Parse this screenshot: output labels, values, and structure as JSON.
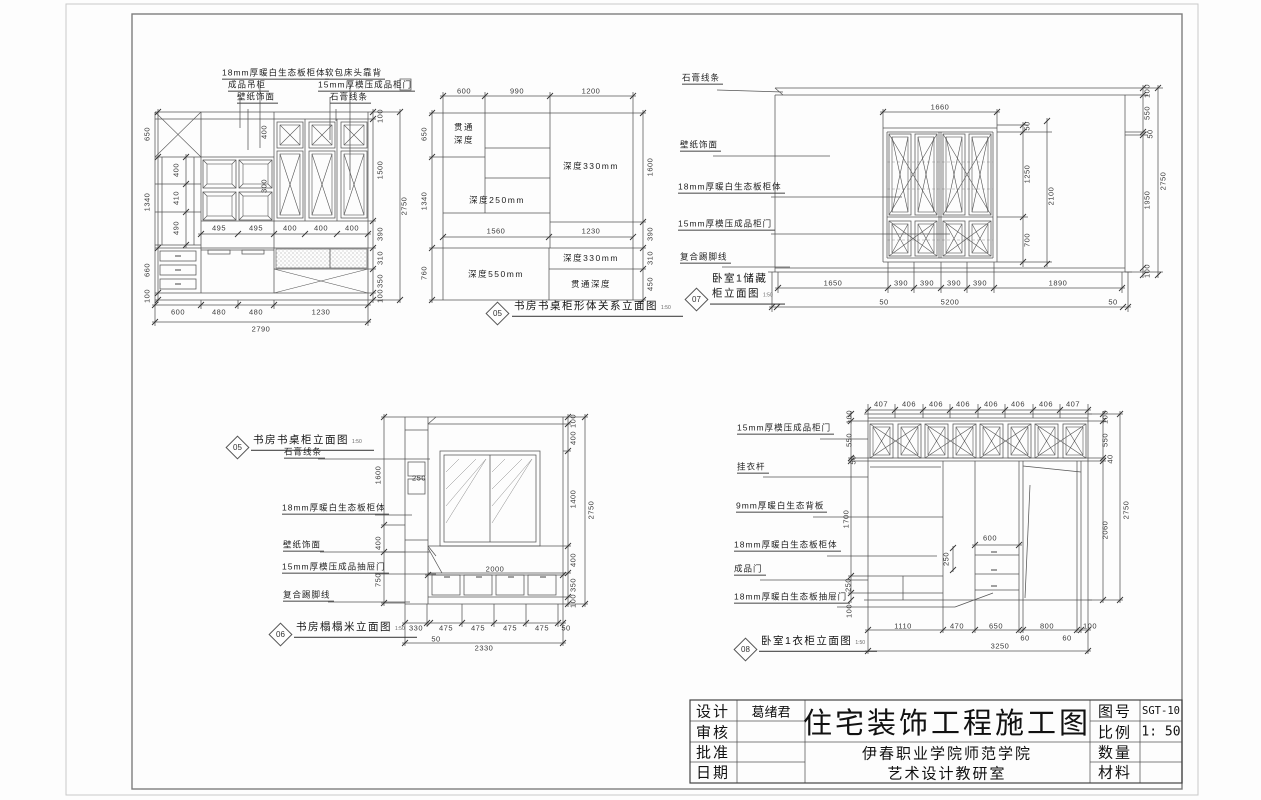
{
  "title_block": {
    "left_rows": [
      {
        "label": "设计",
        "value": "葛绪君"
      },
      {
        "label": "审核",
        "value": ""
      },
      {
        "label": "批准",
        "value": ""
      },
      {
        "label": "日期",
        "value": ""
      }
    ],
    "main_title": "住宅装饰工程施工图",
    "org_lines": [
      "伊春职业学院师范学院",
      "艺术设计教研室"
    ],
    "right_rows": [
      {
        "label": "图号",
        "value": "SGT-10"
      },
      {
        "label": "比例",
        "value": "1: 50"
      },
      {
        "label": "数量",
        "value": ""
      },
      {
        "label": "材料",
        "value": ""
      }
    ]
  },
  "callouts": [
    {
      "num": "05",
      "dx": 497,
      "dy": 313,
      "tx": 512,
      "ty": 317,
      "lines": [
        "书房书桌柜形体关系立面图"
      ],
      "scale": "1:50"
    },
    {
      "num": "07",
      "dx": 696,
      "dy": 299,
      "tx": 710,
      "ty": 305,
      "lines": [
        "卧室1储藏",
        "柜立面图"
      ],
      "scale": "1:50"
    },
    {
      "num": "05",
      "dx": 237,
      "dy": 447,
      "tx": 251,
      "ty": 451,
      "lines": [
        "书房书桌柜立面图"
      ],
      "scale": "1:50"
    },
    {
      "num": "06",
      "dx": 280,
      "dy": 634,
      "tx": 294,
      "ty": 638,
      "lines": [
        "书房榻榻米立面图"
      ],
      "scale": "1:50"
    },
    {
      "num": "08",
      "dx": 745,
      "dy": 649,
      "tx": 759,
      "ty": 652,
      "lines": [
        "卧室1衣柜立面图"
      ],
      "scale": "1:50"
    }
  ],
  "annotations": [
    {
      "k": "l",
      "t": "18mm厚暖白生态板柜体",
      "x": 222,
      "y": 80,
      "u": 1
    },
    {
      "k": "l",
      "t": "软包床头靠背",
      "x": 325,
      "y": 80,
      "u": 1
    },
    {
      "k": "l",
      "t": "成品吊柜",
      "x": 228,
      "y": 92,
      "u": 1
    },
    {
      "k": "l",
      "t": "15mm厚模压成品柜门",
      "x": 318,
      "y": 92,
      "u": 1
    },
    {
      "k": "l",
      "t": "壁纸饰面",
      "x": 237,
      "y": 104,
      "u": 1
    },
    {
      "k": "l",
      "t": "石膏线条",
      "x": 330,
      "y": 104,
      "u": 1
    },
    {
      "k": "d",
      "t": "650",
      "x": 147,
      "y": 134,
      "r": 1
    },
    {
      "k": "d",
      "t": "1340",
      "x": 147,
      "y": 202,
      "r": 1
    },
    {
      "k": "d",
      "t": "660",
      "x": 147,
      "y": 270,
      "r": 1
    },
    {
      "k": "d",
      "t": "100",
      "x": 147,
      "y": 296,
      "r": 1
    },
    {
      "k": "d",
      "t": "400",
      "x": 176,
      "y": 170,
      "r": 1
    },
    {
      "k": "d",
      "t": "410",
      "x": 176,
      "y": 198,
      "r": 1
    },
    {
      "k": "d",
      "t": "490",
      "x": 176,
      "y": 228,
      "r": 1
    },
    {
      "k": "d",
      "t": "400",
      "x": 264,
      "y": 132,
      "r": 1
    },
    {
      "k": "d",
      "t": "300",
      "x": 264,
      "y": 186,
      "r": 1
    },
    {
      "k": "d",
      "t": "495",
      "x": 219,
      "y": 228
    },
    {
      "k": "d",
      "t": "495",
      "x": 256,
      "y": 228
    },
    {
      "k": "d",
      "t": "400",
      "x": 290,
      "y": 228
    },
    {
      "k": "d",
      "t": "400",
      "x": 321,
      "y": 228
    },
    {
      "k": "d",
      "t": "400",
      "x": 352,
      "y": 228
    },
    {
      "k": "d",
      "t": "600",
      "x": 178,
      "y": 312
    },
    {
      "k": "d",
      "t": "480",
      "x": 219,
      "y": 312
    },
    {
      "k": "d",
      "t": "480",
      "x": 256,
      "y": 312
    },
    {
      "k": "d",
      "t": "1230",
      "x": 321,
      "y": 312
    },
    {
      "k": "d",
      "t": "2790",
      "x": 261,
      "y": 329
    },
    {
      "k": "d",
      "t": "100",
      "x": 380,
      "y": 116,
      "r": 1
    },
    {
      "k": "d",
      "t": "1500",
      "x": 380,
      "y": 170,
      "r": 1
    },
    {
      "k": "d",
      "t": "390",
      "x": 380,
      "y": 234,
      "r": 1
    },
    {
      "k": "d",
      "t": "310",
      "x": 380,
      "y": 258,
      "r": 1
    },
    {
      "k": "d",
      "t": "350",
      "x": 380,
      "y": 281,
      "r": 1
    },
    {
      "k": "d",
      "t": "100",
      "x": 380,
      "y": 296,
      "r": 1
    },
    {
      "k": "d",
      "t": "2750",
      "x": 404,
      "y": 206,
      "r": 1
    },
    {
      "k": "d",
      "t": "600",
      "x": 464,
      "y": 91
    },
    {
      "k": "d",
      "t": "990",
      "x": 517,
      "y": 91
    },
    {
      "k": "d",
      "t": "1200",
      "x": 591,
      "y": 91
    },
    {
      "k": "d",
      "t": "650",
      "x": 424,
      "y": 134,
      "r": 1
    },
    {
      "k": "d",
      "t": "1340",
      "x": 424,
      "y": 201,
      "r": 1
    },
    {
      "k": "d",
      "t": "760",
      "x": 424,
      "y": 273,
      "r": 1
    },
    {
      "k": "d",
      "t": "1560",
      "x": 496,
      "y": 231
    },
    {
      "k": "d",
      "t": "1230",
      "x": 591,
      "y": 231
    },
    {
      "k": "d",
      "t": "1600",
      "x": 650,
      "y": 167,
      "r": 1
    },
    {
      "k": "d",
      "t": "390",
      "x": 650,
      "y": 234,
      "r": 1
    },
    {
      "k": "d",
      "t": "310",
      "x": 650,
      "y": 258,
      "r": 1
    },
    {
      "k": "d",
      "t": "450",
      "x": 650,
      "y": 284,
      "r": 1
    },
    {
      "k": "n",
      "t": "贯通",
      "x": 464,
      "y": 127
    },
    {
      "k": "n",
      "t": "深度",
      "x": 464,
      "y": 140
    },
    {
      "k": "n",
      "t": "深度330mm",
      "x": 591,
      "y": 166
    },
    {
      "k": "n",
      "t": "深度250mm",
      "x": 497,
      "y": 200
    },
    {
      "k": "n",
      "t": "深度550mm",
      "x": 496,
      "y": 274
    },
    {
      "k": "n",
      "t": "深度330mm",
      "x": 591,
      "y": 258
    },
    {
      "k": "n",
      "t": "贯通深度",
      "x": 591,
      "y": 284
    },
    {
      "k": "l",
      "t": "石膏线条",
      "x": 682,
      "y": 85,
      "u": 1
    },
    {
      "k": "l",
      "t": "壁纸饰面",
      "x": 680,
      "y": 152,
      "u": 1
    },
    {
      "k": "l",
      "t": "18mm厚暖白生态板柜体",
      "x": 678,
      "y": 194,
      "u": 1
    },
    {
      "k": "l",
      "t": "15mm厚模压成品柜门",
      "x": 678,
      "y": 231,
      "u": 1
    },
    {
      "k": "l",
      "t": "复合踢脚线",
      "x": 680,
      "y": 264,
      "u": 1
    },
    {
      "k": "d",
      "t": "1660",
      "x": 940,
      "y": 107
    },
    {
      "k": "d",
      "t": "50",
      "x": 1027,
      "y": 126,
      "r": 1
    },
    {
      "k": "d",
      "t": "1250",
      "x": 1027,
      "y": 174,
      "r": 1
    },
    {
      "k": "d",
      "t": "700",
      "x": 1027,
      "y": 240,
      "r": 1
    },
    {
      "k": "d",
      "t": "2100",
      "x": 1051,
      "y": 196,
      "r": 1
    },
    {
      "k": "d",
      "t": "100",
      "x": 1147,
      "y": 91,
      "r": 1
    },
    {
      "k": "d",
      "t": "550",
      "x": 1147,
      "y": 113,
      "r": 1
    },
    {
      "k": "d",
      "t": "50",
      "x": 1150,
      "y": 134,
      "r": 1
    },
    {
      "k": "d",
      "t": "1950",
      "x": 1147,
      "y": 200,
      "r": 1
    },
    {
      "k": "d",
      "t": "100",
      "x": 1147,
      "y": 271,
      "r": 1
    },
    {
      "k": "d",
      "t": "2750",
      "x": 1163,
      "y": 181,
      "r": 1
    },
    {
      "k": "d",
      "t": "1650",
      "x": 833,
      "y": 283
    },
    {
      "k": "d",
      "t": "390",
      "x": 901,
      "y": 283
    },
    {
      "k": "d",
      "t": "390",
      "x": 927,
      "y": 283
    },
    {
      "k": "d",
      "t": "390",
      "x": 954,
      "y": 283
    },
    {
      "k": "d",
      "t": "390",
      "x": 980,
      "y": 283
    },
    {
      "k": "d",
      "t": "1890",
      "x": 1058,
      "y": 283
    },
    {
      "k": "d",
      "t": "50",
      "x": 884,
      "y": 302
    },
    {
      "k": "d",
      "t": "5200",
      "x": 950,
      "y": 302
    },
    {
      "k": "d",
      "t": "50",
      "x": 1113,
      "y": 302
    },
    {
      "k": "l",
      "t": "石膏线条",
      "x": 284,
      "y": 459,
      "u": 1
    },
    {
      "k": "l",
      "t": "18mm厚暖白生态板柜体",
      "x": 282,
      "y": 515,
      "u": 1
    },
    {
      "k": "l",
      "t": "壁纸饰面",
      "x": 283,
      "y": 552,
      "u": 1
    },
    {
      "k": "l",
      "t": "15mm厚模压成品抽屉门",
      "x": 282,
      "y": 574,
      "u": 1
    },
    {
      "k": "l",
      "t": "复合踢脚线",
      "x": 283,
      "y": 602,
      "u": 1
    },
    {
      "k": "d",
      "t": "1600",
      "x": 378,
      "y": 475,
      "r": 1
    },
    {
      "k": "d",
      "t": "400",
      "x": 378,
      "y": 543,
      "r": 1
    },
    {
      "k": "d",
      "t": "750",
      "x": 378,
      "y": 580,
      "r": 1
    },
    {
      "k": "d",
      "t": "250",
      "x": 419,
      "y": 478
    },
    {
      "k": "d",
      "t": "2000",
      "x": 495,
      "y": 569
    },
    {
      "k": "d",
      "t": "100",
      "x": 573,
      "y": 421,
      "r": 1
    },
    {
      "k": "d",
      "t": "400",
      "x": 573,
      "y": 438,
      "r": 1
    },
    {
      "k": "d",
      "t": "1400",
      "x": 573,
      "y": 499,
      "r": 1
    },
    {
      "k": "d",
      "t": "400",
      "x": 573,
      "y": 560,
      "r": 1
    },
    {
      "k": "d",
      "t": "350",
      "x": 573,
      "y": 585,
      "r": 1
    },
    {
      "k": "d",
      "t": "100",
      "x": 573,
      "y": 601,
      "r": 1
    },
    {
      "k": "d",
      "t": "2750",
      "x": 591,
      "y": 510,
      "r": 1
    },
    {
      "k": "d",
      "t": "330",
      "x": 416,
      "y": 628
    },
    {
      "k": "d",
      "t": "475",
      "x": 446,
      "y": 628
    },
    {
      "k": "d",
      "t": "475",
      "x": 478,
      "y": 628
    },
    {
      "k": "d",
      "t": "475",
      "x": 510,
      "y": 628
    },
    {
      "k": "d",
      "t": "475",
      "x": 542,
      "y": 628
    },
    {
      "k": "d",
      "t": "50",
      "x": 566,
      "y": 628
    },
    {
      "k": "d",
      "t": "50",
      "x": 436,
      "y": 639
    },
    {
      "k": "d",
      "t": "2330",
      "x": 484,
      "y": 648
    },
    {
      "k": "l",
      "t": "15mm厚模压成品柜门",
      "x": 737,
      "y": 435,
      "u": 1
    },
    {
      "k": "l",
      "t": "挂衣杆",
      "x": 737,
      "y": 474,
      "u": 1
    },
    {
      "k": "l",
      "t": "9mm厚暖白生态背板",
      "x": 736,
      "y": 513,
      "u": 1
    },
    {
      "k": "l",
      "t": "18mm厚暖白生态板柜体",
      "x": 734,
      "y": 552,
      "u": 1
    },
    {
      "k": "l",
      "t": "成品门",
      "x": 734,
      "y": 576,
      "u": 1
    },
    {
      "k": "l",
      "t": "18mm厚暖白生态板抽屉门",
      "x": 734,
      "y": 604,
      "u": 1
    },
    {
      "k": "d",
      "t": "407",
      "x": 881,
      "y": 404
    },
    {
      "k": "d",
      "t": "406",
      "x": 909,
      "y": 404
    },
    {
      "k": "d",
      "t": "406",
      "x": 936,
      "y": 404
    },
    {
      "k": "d",
      "t": "406",
      "x": 963,
      "y": 404
    },
    {
      "k": "d",
      "t": "406",
      "x": 991,
      "y": 404
    },
    {
      "k": "d",
      "t": "406",
      "x": 1018,
      "y": 404
    },
    {
      "k": "d",
      "t": "406",
      "x": 1046,
      "y": 404
    },
    {
      "k": "d",
      "t": "407",
      "x": 1073,
      "y": 404
    },
    {
      "k": "d",
      "t": "100",
      "x": 849,
      "y": 417,
      "r": 1
    },
    {
      "k": "d",
      "t": "550",
      "x": 849,
      "y": 440,
      "r": 1
    },
    {
      "k": "d",
      "t": "50",
      "x": 853,
      "y": 460,
      "r": 1
    },
    {
      "k": "d",
      "t": "1700",
      "x": 846,
      "y": 519,
      "r": 1
    },
    {
      "k": "d",
      "t": "250",
      "x": 848,
      "y": 585,
      "r": 1
    },
    {
      "k": "d",
      "t": "100",
      "x": 849,
      "y": 611,
      "r": 1
    },
    {
      "k": "d",
      "t": "600",
      "x": 990,
      "y": 538
    },
    {
      "k": "d",
      "t": "250",
      "x": 946,
      "y": 559,
      "r": 1
    },
    {
      "k": "d",
      "t": "100",
      "x": 1105,
      "y": 417,
      "r": 1
    },
    {
      "k": "d",
      "t": "550",
      "x": 1105,
      "y": 440,
      "r": 1
    },
    {
      "k": "d",
      "t": "40",
      "x": 1110,
      "y": 459,
      "r": 1
    },
    {
      "k": "d",
      "t": "2060",
      "x": 1105,
      "y": 530,
      "r": 1
    },
    {
      "k": "d",
      "t": "2750",
      "x": 1126,
      "y": 510,
      "r": 1
    },
    {
      "k": "d",
      "t": "1110",
      "x": 903,
      "y": 626
    },
    {
      "k": "d",
      "t": "470",
      "x": 957,
      "y": 626
    },
    {
      "k": "d",
      "t": "650",
      "x": 996,
      "y": 626
    },
    {
      "k": "d",
      "t": "800",
      "x": 1047,
      "y": 626
    },
    {
      "k": "d",
      "t": "100",
      "x": 1090,
      "y": 626
    },
    {
      "k": "d",
      "t": "60",
      "x": 1025,
      "y": 638
    },
    {
      "k": "d",
      "t": "60",
      "x": 1067,
      "y": 638
    },
    {
      "k": "d",
      "t": "3250",
      "x": 1000,
      "y": 646
    }
  ]
}
